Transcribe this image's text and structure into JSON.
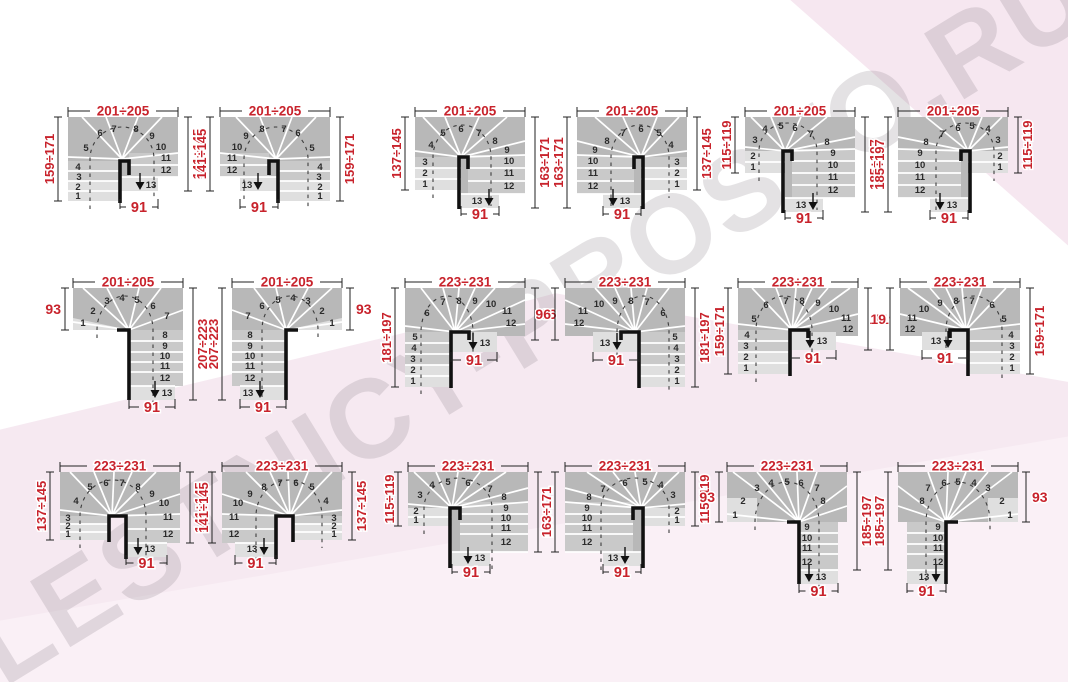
{
  "watermark": {
    "text": "LESTNICY-PROSTO.RU"
  },
  "steps": [
    "1",
    "2",
    "3",
    "4",
    "5",
    "6",
    "7",
    "8",
    "9",
    "10",
    "11",
    "12",
    "13"
  ],
  "colors": {
    "accent_red": "#c8232c",
    "step_dark": "#b8b8b8",
    "step_mid": "#c9c9c9",
    "step_light": "#dfdfdf",
    "line_black": "#222222",
    "bar_black": "#111111",
    "bg_pink": "#f6e9f1"
  },
  "diagrams": [
    {
      "id": "r1-1",
      "type": "A",
      "mirrored": false,
      "width_label": "201÷205",
      "left_label": "159÷171",
      "right_label": "141÷145",
      "exit_label": "91"
    },
    {
      "id": "r1-2",
      "type": "A",
      "mirrored": true,
      "width_label": "201÷205",
      "left_label": "141÷145",
      "right_label": "159÷171",
      "exit_label": "91"
    },
    {
      "id": "r1-3",
      "type": "B",
      "mirrored": false,
      "width_label": "201÷205",
      "left_label": "137÷145",
      "right_label": "163÷171",
      "exit_label": "91"
    },
    {
      "id": "r1-4",
      "type": "B",
      "mirrored": true,
      "width_label": "201÷205",
      "left_label": "163÷171",
      "right_label": "137÷145",
      "exit_label": "91"
    },
    {
      "id": "r1-5",
      "type": "C",
      "mirrored": false,
      "width_label": "201÷205",
      "left_label": "115÷119",
      "right_label": "185÷197",
      "exit_label": "91"
    },
    {
      "id": "r1-6",
      "type": "C",
      "mirrored": true,
      "width_label": "201÷205",
      "left_label": "185÷197",
      "right_label": "115÷119",
      "exit_label": "91"
    },
    {
      "id": "r2-1",
      "type": "D",
      "mirrored": false,
      "width_label": "201÷205",
      "left_label": "93",
      "right_label": "207÷223",
      "exit_label": "91"
    },
    {
      "id": "r2-2",
      "type": "D",
      "mirrored": true,
      "width_label": "201÷205",
      "left_label": "207÷223",
      "right_label": "93",
      "exit_label": "91"
    },
    {
      "id": "r2-3",
      "type": "E",
      "mirrored": false,
      "width_label": "223÷231",
      "left_label": "181÷197",
      "right_label": "96",
      "exit_label": "91"
    },
    {
      "id": "r2-4",
      "type": "E",
      "mirrored": true,
      "width_label": "223÷231",
      "left_label": "96",
      "right_label": "181÷197",
      "exit_label": "91"
    },
    {
      "id": "r2-5",
      "type": "F",
      "mirrored": false,
      "width_label": "223÷231",
      "left_label": "159÷171",
      "right_label": "119",
      "exit_label": "91"
    },
    {
      "id": "r2-6",
      "type": "F",
      "mirrored": true,
      "width_label": "223÷231",
      "left_label": "119",
      "right_label": "159÷171",
      "exit_label": "91"
    },
    {
      "id": "r3-1",
      "type": "G",
      "mirrored": false,
      "width_label": "223÷231",
      "left_label": "137÷145",
      "right_label": "141÷145",
      "exit_label": "91"
    },
    {
      "id": "r3-2",
      "type": "G",
      "mirrored": true,
      "width_label": "223÷231",
      "left_label": "141÷145",
      "right_label": "137÷145",
      "exit_label": "91"
    },
    {
      "id": "r3-3",
      "type": "H",
      "mirrored": false,
      "width_label": "223÷231",
      "left_label": "115÷119",
      "right_label": "163÷171",
      "exit_label": "91"
    },
    {
      "id": "r3-4",
      "type": "H",
      "mirrored": true,
      "width_label": "223÷231",
      "left_label": "163÷171",
      "right_label": "115÷119",
      "exit_label": "91"
    },
    {
      "id": "r3-5",
      "type": "I",
      "mirrored": false,
      "width_label": "223÷231",
      "left_label": "93",
      "right_label": "185÷197",
      "exit_label": "91"
    },
    {
      "id": "r3-6",
      "type": "I",
      "mirrored": true,
      "width_label": "223÷231",
      "left_label": "185÷197",
      "right_label": "93",
      "exit_label": "91"
    }
  ]
}
